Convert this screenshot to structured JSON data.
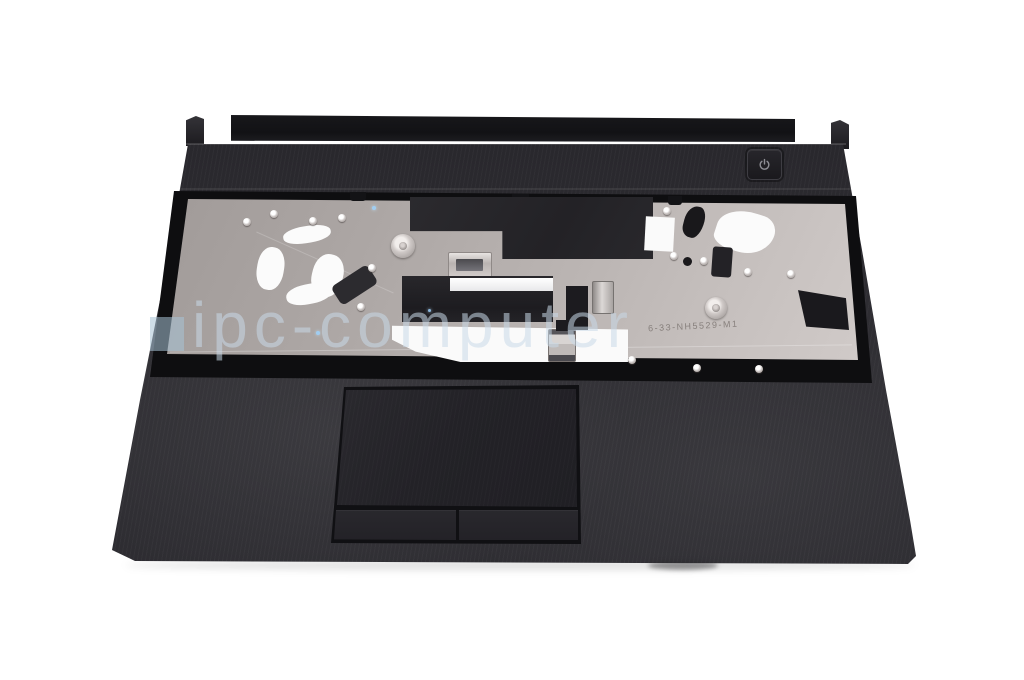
{
  "photo": {
    "subject": "laptop-topcase-palmrest",
    "watermark_text": "ipc-computer",
    "plate_part_number": "6-33-NH5529-M1",
    "colors": {
      "background": "#ffffff",
      "palmrest_plastic": "#2c2b30",
      "hinge_bar": "#17171a",
      "keyboard_plate_metal": "#b9b3b1",
      "cutout_white": "#fafafa",
      "mylar_film_black": "#232226",
      "watermark_blue": "#c8d9e7"
    },
    "icons": {
      "power_button_glyph": "power-icon"
    }
  }
}
